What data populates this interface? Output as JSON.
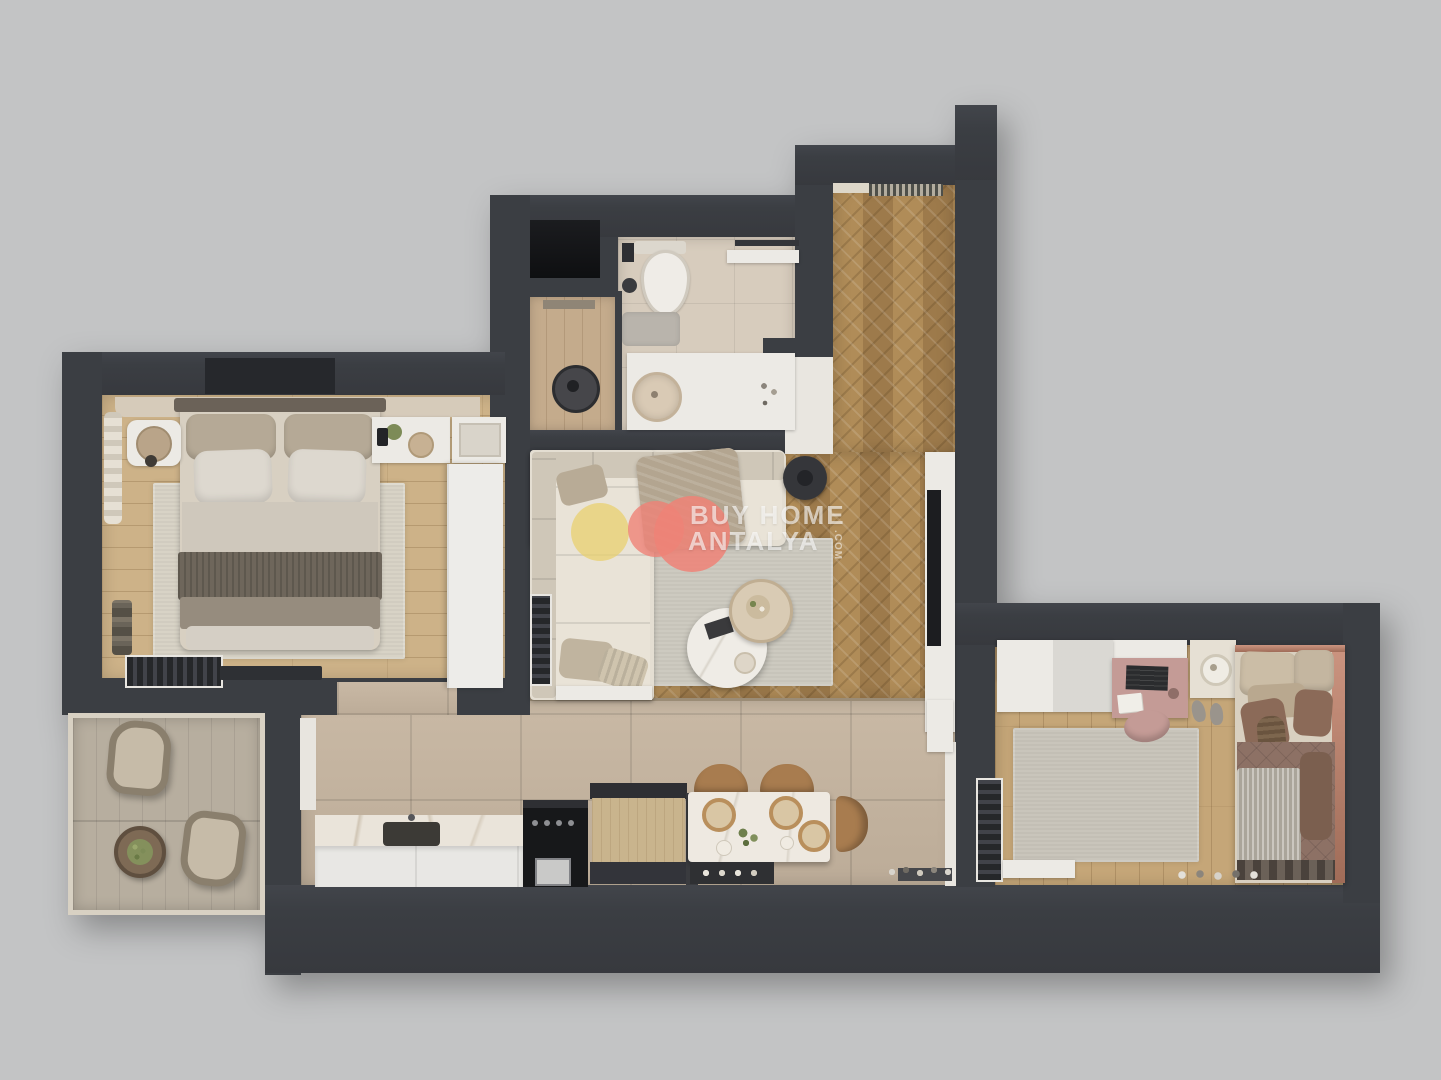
{
  "watermark": {
    "brand_line1": "BUY HOME",
    "brand_line2": "ANTALYA",
    "brand_suffix": ".COM"
  },
  "palette": {
    "background": "#c3c4c5",
    "wall": "#3b3e43",
    "herringbone_wood": "#a98753",
    "plank_wood": "#cdb288",
    "tile": "#c6b5a0",
    "bath_tile": "#d7ccbd",
    "balcony_floor": "#b7ae9f",
    "bedroom2_wood": "#c5a678",
    "rug": "#cdcac0",
    "sofa": "#e4ded2",
    "accent_yellow": "#e9d06b",
    "accent_salmon": "#ef8277",
    "copper_trim": "#b57d6d",
    "counter_black": "#17181a",
    "dining_chair": "#a87c4f"
  },
  "scene": {
    "type": "3d-floor-plan-top-view",
    "rooms": [
      "entry-hall",
      "bathroom",
      "laundry-niche",
      "living-room",
      "master-bedroom",
      "kitchen-dining",
      "second-bedroom",
      "balcony"
    ]
  }
}
